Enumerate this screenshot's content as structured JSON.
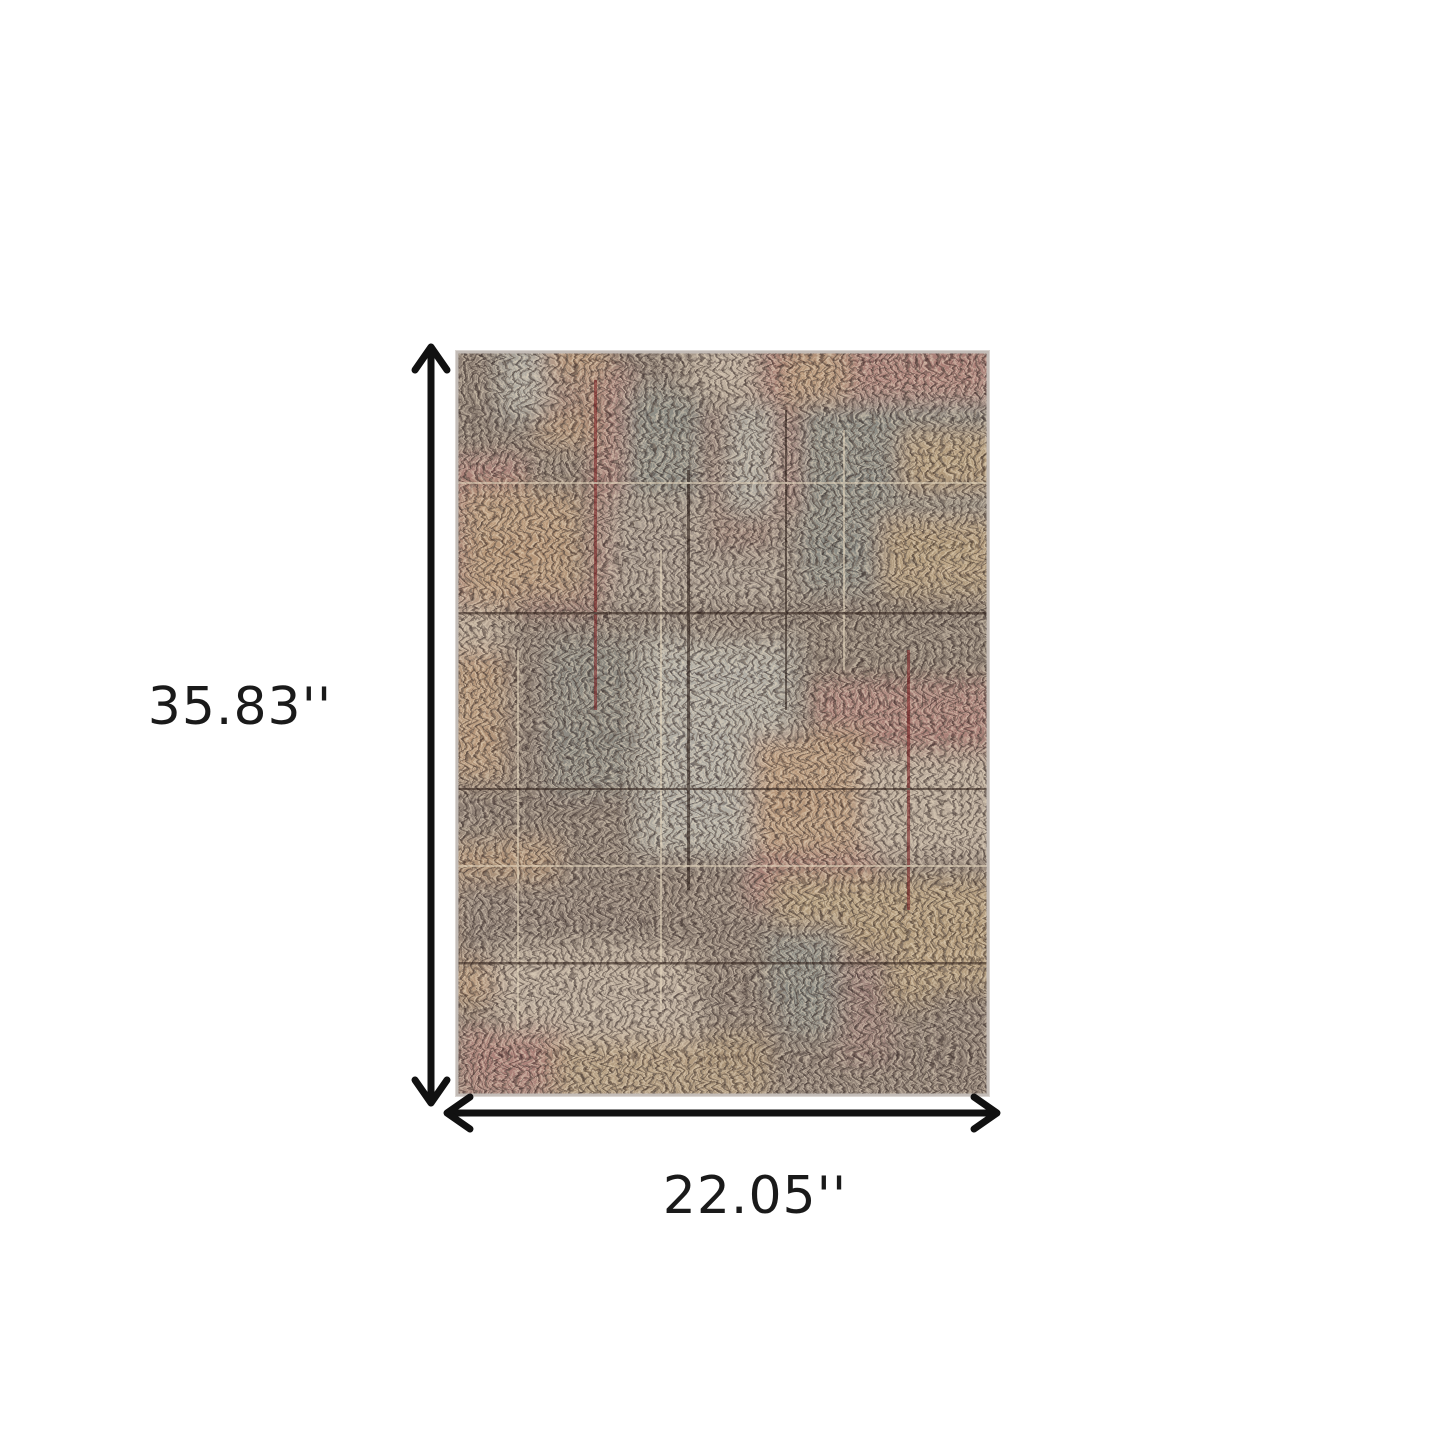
{
  "page": {
    "description": "Product dimension diagram of an area rug on a white background",
    "background_color": "#ffffff"
  },
  "rug_image": {
    "description": "Abstract distressed crosshatch area rug with patches of dark brown, teal, crimson red, burnt orange, mustard gold, light blue, cream, beige and grey",
    "border_color": "#c3bcb7",
    "palette": {
      "dark_brown": "#32241d",
      "teal": "#2c555c",
      "red": "#9e2227",
      "maroon": "#6b1f22",
      "orange": "#d07c2e",
      "gold": "#c08e35",
      "light_blue": "#b8d6d8",
      "cream": "#e4d6bf",
      "beige": "#c3b29c",
      "grey": "#918a82"
    }
  },
  "annotations": {
    "arrow_color": "#111111",
    "text_color": "#1a1a1a",
    "height": {
      "label": "35.83''"
    },
    "width": {
      "label": "22.05''"
    }
  }
}
